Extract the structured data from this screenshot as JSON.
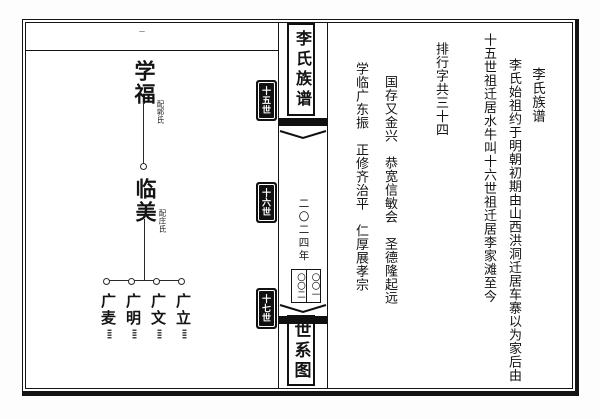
{
  "colors": {
    "ink": "#141414",
    "paper": "#ffffff"
  },
  "left_page": {
    "corner_mark": "一",
    "tree": {
      "ancestor": {
        "name": "学福",
        "spouse_note": "配郭氏"
      },
      "descendant": {
        "name": "临美",
        "spouse_note": "配庄氏"
      },
      "children": [
        {
          "name": "广麦",
          "note": "〓〓"
        },
        {
          "name": "广明",
          "note": "〓〓"
        },
        {
          "name": "广文",
          "note": "〓〓"
        },
        {
          "name": "广立",
          "note": "〓〓"
        }
      ]
    }
  },
  "spine": {
    "title": "李氏族谱",
    "year": "二〇二四年",
    "page_number_right": "〇〇一",
    "page_number_left": "〇〇二",
    "section": "世系图",
    "tabs": [
      {
        "label": "十五世"
      },
      {
        "label": "十六世"
      },
      {
        "label": "十七世"
      }
    ]
  },
  "right_page": {
    "columns": [
      {
        "text": "李氏族谱"
      },
      {
        "text": "李氏始祖约于明朝初期由山西洪洞迁居车寨以为家后由"
      },
      {
        "text": "十五世祖迁居水牛叫十六世祖迁居李家滩至今"
      },
      {
        "text": "排行字共三十四"
      },
      {
        "text": "国存又金兴　恭宽信敏会　圣德隆起远"
      },
      {
        "text": "学临广东振　正修齐治平　仁厚展孝宗"
      }
    ]
  }
}
